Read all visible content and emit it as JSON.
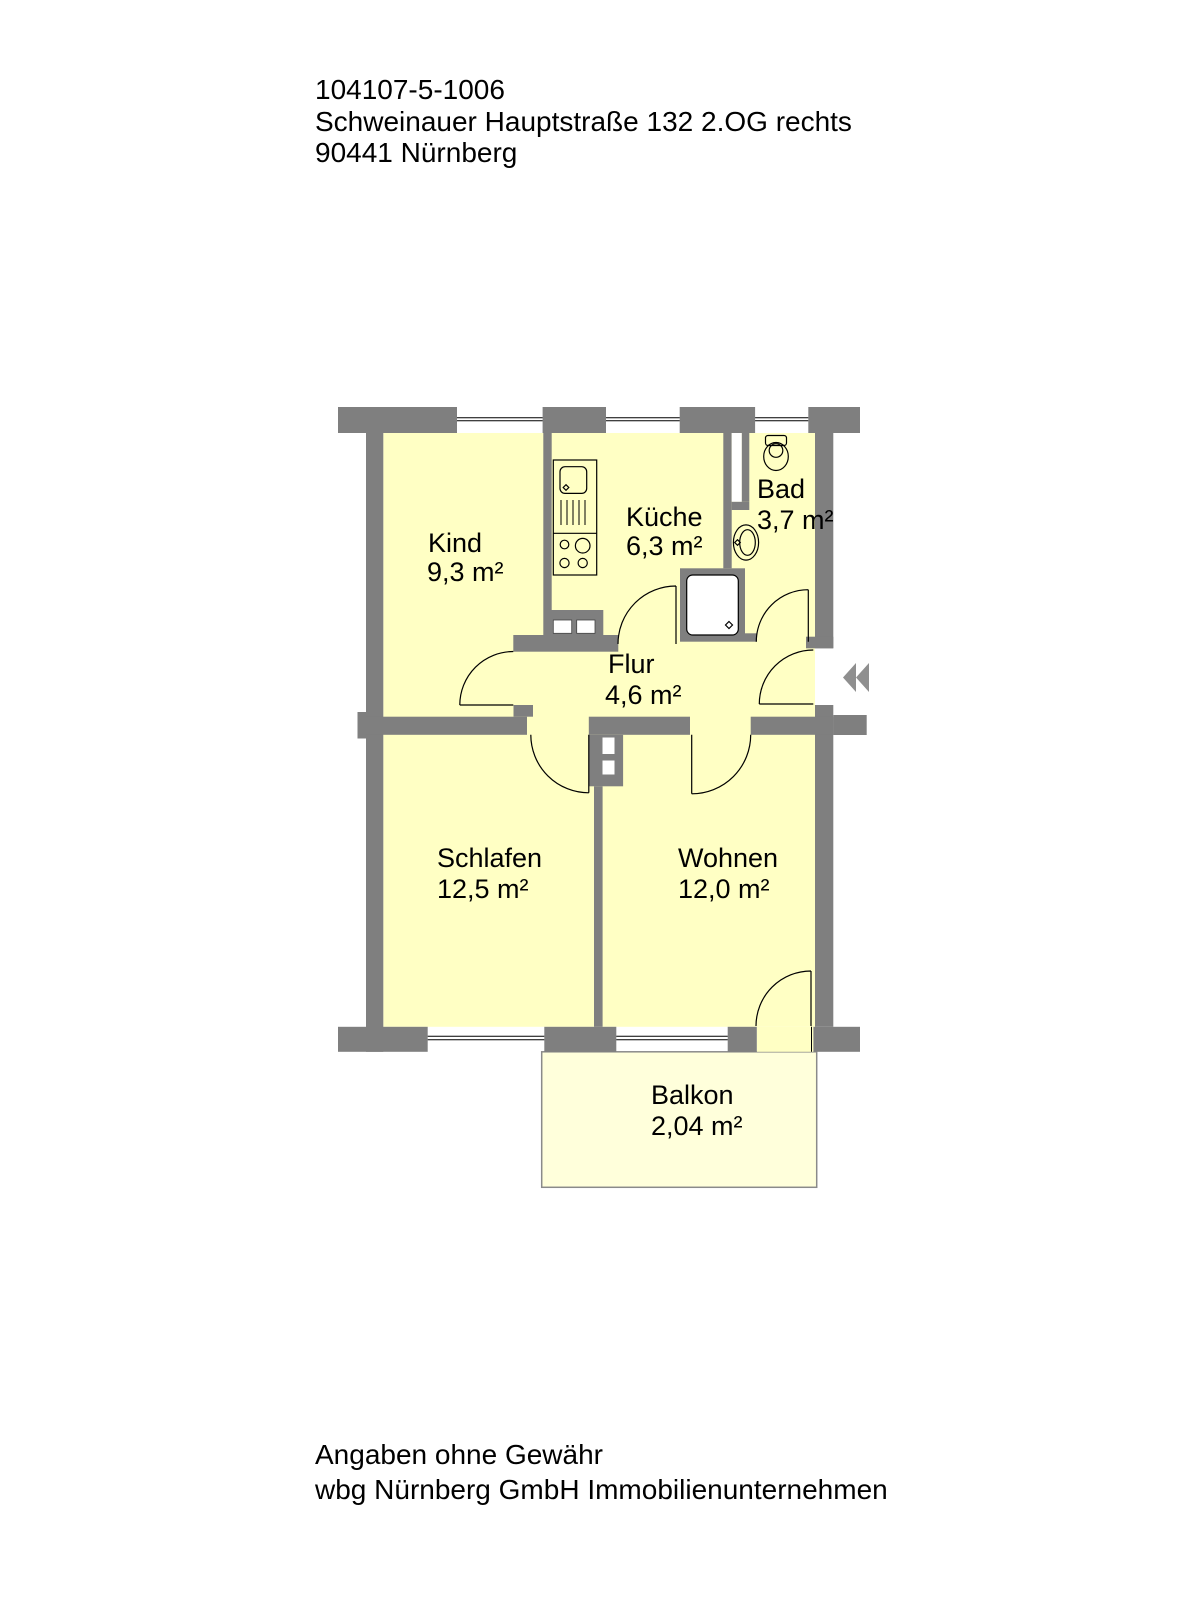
{
  "header": {
    "object_id": "104107-5-1006",
    "address_line": "Schweinauer Hauptstraße 132 2.OG rechts",
    "city_line": "90441 Nürnberg"
  },
  "floorplan": {
    "rooms": [
      {
        "name": "Kind",
        "area": "9,3 m²"
      },
      {
        "name": "Küche",
        "area": "6,3 m²"
      },
      {
        "name": "Bad",
        "area": "3,7 m²"
      },
      {
        "name": "Flur",
        "area": "4,6 m²"
      },
      {
        "name": "Schlafen",
        "area": "12,5 m²"
      },
      {
        "name": "Wohnen",
        "area": "12,0 m²"
      },
      {
        "name": "Balkon",
        "area": "2,04 m²"
      }
    ],
    "fixtures": [
      "kitchen-sink-unit",
      "stove",
      "ventilation-shaft",
      "toilet",
      "washbasin",
      "shower",
      "duct"
    ],
    "entrance_marker": "double-chevron-left",
    "colors": {
      "wall": "#7f7f7f",
      "room_fill": "#ffffc4",
      "balcony_fill": "#ffffdb",
      "marker": "#8f8f8f",
      "outline": "#000000"
    }
  },
  "footer": {
    "disclaimer": "Angaben ohne Gewähr",
    "company": "wbg Nürnberg GmbH Immobilienunternehmen"
  }
}
